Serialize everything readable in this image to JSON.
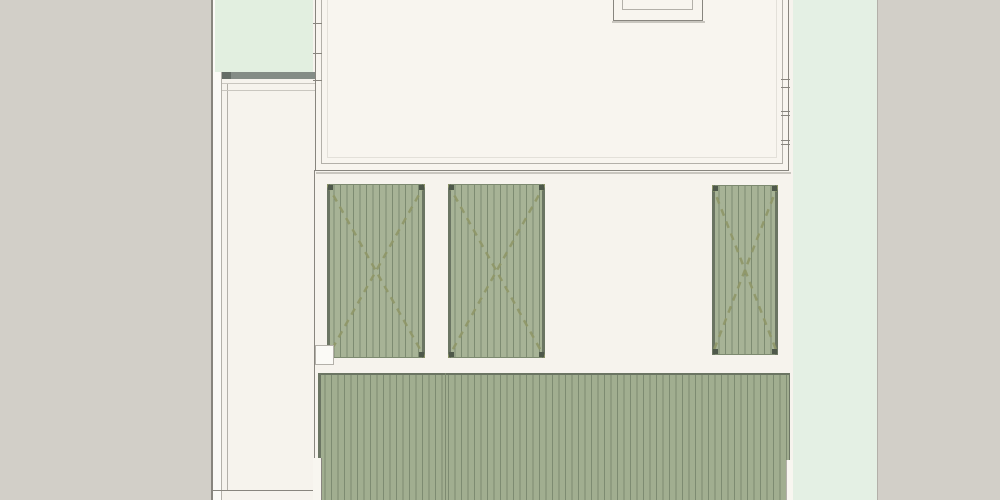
{
  "drawing": {
    "kind": "architectural-site-plan",
    "canvas": {
      "width": 1000,
      "height": 500
    }
  },
  "palette": {
    "background_gray": "#d2cfc8",
    "cream": "#f6f3ed",
    "cream_bright": "#f8f6f0",
    "building_fill": "#f8f5ef",
    "mint_left": "#e2efe0",
    "mint_right": "#e4f0e4",
    "panel_fill": "#a7b396",
    "deck_fill": "#a1ae90",
    "deck_stripe": "#7d8b71",
    "deck_edge": "#6b7563",
    "deck_top_line": "#7d8a70",
    "dash_olive": "#8f9768",
    "corner_dot": "#4e584a",
    "line_dark": "#88857e",
    "line_mid": "#b3b0a9",
    "line_light": "#c9c6bf",
    "line_faint": "#e3e0d9",
    "bar_fill": "#848c86",
    "bar_cap": "#656d67",
    "white": "#fbfaf6"
  },
  "layers_base": [
    {
      "name": "patio-ground",
      "fill": "cream",
      "x": 313,
      "y": 0,
      "w": 480,
      "h": 500
    },
    {
      "name": "right-verge",
      "fill": "mint_right",
      "x": 793,
      "y": 0,
      "w": 84,
      "h": 500
    },
    {
      "name": "right-verge-edge-line",
      "fill": "line_mid",
      "x": 877,
      "y": 0,
      "w": 1,
      "h": 500
    },
    {
      "name": "left-boundary-line",
      "fill": "line_dark",
      "x": 211,
      "y": 0,
      "w": 2,
      "h": 500
    },
    {
      "name": "left-boundary-gap",
      "fill": "white",
      "x": 213,
      "y": 0,
      "w": 9,
      "h": 500
    },
    {
      "name": "left-passage",
      "fill": "cream",
      "x": 222,
      "y": 0,
      "w": 91,
      "h": 500
    },
    {
      "name": "left-boundary-inner-line",
      "fill": "line_mid",
      "x": 221,
      "y": 72,
      "w": 1,
      "h": 428
    },
    {
      "name": "passage-fence-line",
      "fill": "line_mid",
      "x": 227,
      "y": 83,
      "w": 1,
      "h": 407
    },
    {
      "name": "left-court",
      "fill": "mint_left",
      "x": 215,
      "y": 0,
      "w": 98,
      "h": 72
    },
    {
      "name": "court-edge-bar",
      "fill": "bar_fill",
      "x": 222,
      "y": 72,
      "w": 93,
      "h": 7
    },
    {
      "name": "court-edge-bar-cap",
      "fill": "bar_cap",
      "x": 222,
      "y": 72,
      "w": 9,
      "h": 7
    },
    {
      "name": "passage-step-line-a",
      "fill": "line_light",
      "x": 222,
      "y": 83,
      "w": 93,
      "h": 1
    },
    {
      "name": "passage-step-line-b",
      "fill": "line_light",
      "x": 222,
      "y": 90,
      "w": 93,
      "h": 1
    },
    {
      "name": "passage-end-line",
      "fill": "line_dark",
      "x": 213,
      "y": 490,
      "w": 102,
      "h": 1
    },
    {
      "name": "patio-divider-line",
      "fill": "line_dark",
      "x": 314,
      "y": 170,
      "w": 1,
      "h": 288
    },
    {
      "name": "building-outline",
      "fill": "building_fill",
      "border": "line_dark",
      "bw": 1,
      "x": 315,
      "y": -8,
      "w": 474,
      "h": 179
    },
    {
      "name": "building-inner-wall-line",
      "border": "line_mid",
      "bw": 1,
      "x": 321,
      "y": -8,
      "w": 462,
      "h": 172
    },
    {
      "name": "building-inset-line",
      "border": "line_faint",
      "bw": 1,
      "x": 327,
      "y": -8,
      "w": 450,
      "h": 166
    },
    {
      "name": "building-drop-shadow",
      "fill": "line_light",
      "x": 316,
      "y": 172,
      "w": 475,
      "h": 2
    },
    {
      "name": "skylight-shadow",
      "fill": "line_light",
      "x": 612,
      "y": 21,
      "w": 93,
      "h": 2
    },
    {
      "name": "skylight-outer-frame",
      "fill": "building_fill",
      "border": "line_dark",
      "bw": 1,
      "x": 613,
      "y": -8,
      "w": 90,
      "h": 29
    },
    {
      "name": "skylight-inner-frame",
      "border": "line_mid",
      "bw": 1,
      "x": 622,
      "y": -8,
      "w": 71,
      "h": 18
    },
    {
      "name": "window-mullion-left-1",
      "fill": "line_dark",
      "x": 313,
      "y": 23,
      "w": 9,
      "h": 1
    },
    {
      "name": "window-mullion-left-2",
      "fill": "line_dark",
      "x": 313,
      "y": 53,
      "w": 9,
      "h": 1
    },
    {
      "name": "window-mullion-left-3",
      "fill": "line_dark",
      "x": 313,
      "y": 80,
      "w": 9,
      "h": 1
    },
    {
      "name": "window-mullion-right-1",
      "fill": "line_dark",
      "x": 781,
      "y": 79,
      "w": 9,
      "h": 1
    },
    {
      "name": "window-mullion-right-2",
      "fill": "line_dark",
      "x": 781,
      "y": 87,
      "w": 9,
      "h": 1
    },
    {
      "name": "window-mullion-right-3",
      "fill": "line_dark",
      "x": 781,
      "y": 111,
      "w": 9,
      "h": 1
    },
    {
      "name": "window-mullion-right-4",
      "fill": "line_dark",
      "x": 781,
      "y": 115,
      "w": 9,
      "h": 1
    },
    {
      "name": "window-mullion-right-5",
      "fill": "line_dark",
      "x": 781,
      "y": 140,
      "w": 9,
      "h": 1
    },
    {
      "name": "window-mullion-right-6",
      "fill": "line_dark",
      "x": 781,
      "y": 144,
      "w": 9,
      "h": 1
    }
  ],
  "hatch_panels": [
    {
      "name": "deck-panel-left",
      "x": 327,
      "y": 184,
      "w": 98,
      "h": 174
    },
    {
      "name": "deck-panel-middle",
      "x": 448,
      "y": 184,
      "w": 97,
      "h": 174
    },
    {
      "name": "deck-panel-right",
      "x": 712,
      "y": 185,
      "w": 66,
      "h": 170
    }
  ],
  "main_deck": {
    "name": "main-deck",
    "x": 318,
    "y": 373,
    "w": 472,
    "h": 127,
    "seam_x": 445
  },
  "layers_top": [
    {
      "name": "main-deck-left-edge",
      "fill": "deck_edge",
      "x": 318,
      "y": 373,
      "w": 3,
      "h": 85
    },
    {
      "name": "deck-left-notch",
      "fill": "cream_bright",
      "x": 313,
      "y": 458,
      "w": 9,
      "h": 42
    },
    {
      "name": "deck-left-notch-line",
      "fill": "line_dark",
      "x": 321,
      "y": 458,
      "w": 1,
      "h": 42
    },
    {
      "name": "deck-right-notch",
      "fill": "cream_bright",
      "x": 786,
      "y": 460,
      "w": 7,
      "h": 40
    },
    {
      "name": "deck-right-notch-line",
      "fill": "line_mid",
      "x": 786,
      "y": 460,
      "w": 1,
      "h": 40
    },
    {
      "name": "passage-step-box",
      "fill": "white",
      "border": "line_mid",
      "bw": 1,
      "x": 315,
      "y": 345,
      "w": 19,
      "h": 20
    }
  ],
  "hatch_style": {
    "stripe_period_px": 6.5,
    "cross_dash_pattern": "7 6",
    "cross_stroke_width": 2.5,
    "corner_dot_size": 5
  }
}
